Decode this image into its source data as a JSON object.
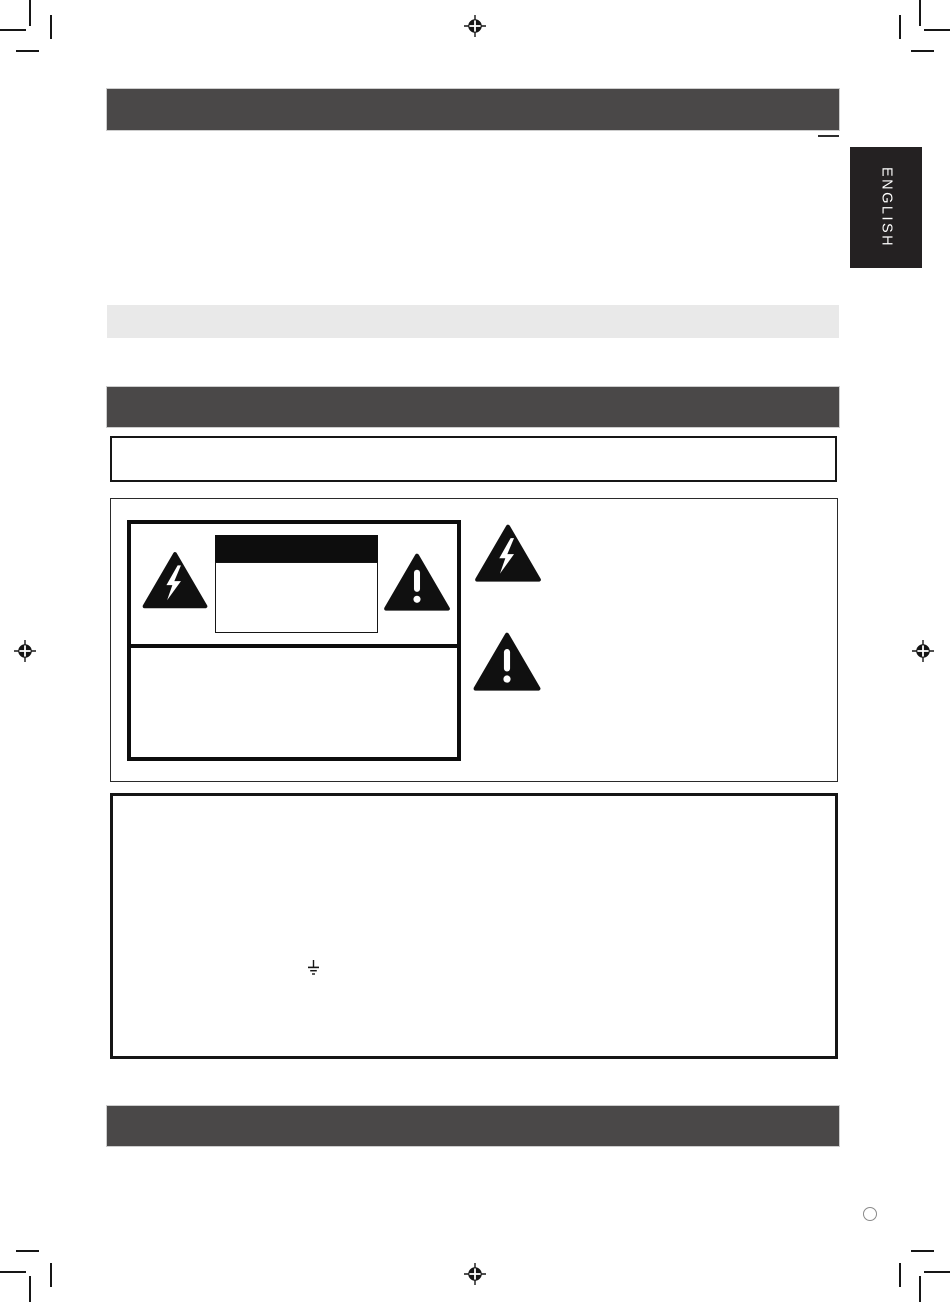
{
  "page": {
    "language_tab_label": "ENGLISH"
  },
  "colors": {
    "page_bg": "#ffffff",
    "ink": "#161616",
    "section_bar_bg": "#4a4848",
    "bar_outline": "#cdcdcd",
    "subsection_bar_bg": "#e9e9e9",
    "tab_bg": "#242122",
    "tab_text": "#ffffff"
  },
  "icons": {
    "registration_mark": "registration-target-icon",
    "crop_mark": "crop-mark-icon",
    "high_voltage_triangle": "lightning-bolt-triangle-icon",
    "alert_triangle": "exclamation-triangle-icon",
    "earth_ground_symbol": "earth-ground-icon",
    "binding_hole": "binding-hole-circle"
  }
}
